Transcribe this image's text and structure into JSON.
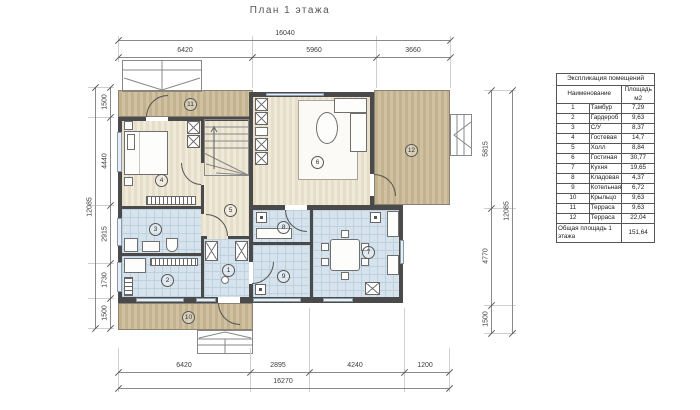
{
  "title": "План 1 этажа",
  "plan": {
    "room_numbers": [
      "1",
      "2",
      "3",
      "4",
      "5",
      "6",
      "7",
      "8",
      "9",
      "10",
      "11",
      "12"
    ]
  },
  "dims": {
    "top": {
      "total": "16040",
      "segments": [
        "6420",
        "5960",
        "3660"
      ]
    },
    "bottom": {
      "total": "16270",
      "segments": [
        "6420",
        "2895",
        "4240",
        "1200"
      ]
    },
    "left": {
      "total": "12085",
      "segments": [
        "1500",
        "4440",
        "2915",
        "1730",
        "1500"
      ]
    },
    "right": {
      "total": "12085",
      "segments": [
        "5815",
        "4770",
        "1500"
      ]
    }
  },
  "table": {
    "title": "Экспликация помещений",
    "columns": {
      "name": "Наименование",
      "area": "Площадь м2"
    },
    "rows": [
      [
        "1",
        "Тамбур",
        "7,29"
      ],
      [
        "2",
        "Гардероб",
        "9,63"
      ],
      [
        "3",
        "С/У",
        "8,37"
      ],
      [
        "4",
        "Гостевая",
        "14,7"
      ],
      [
        "5",
        "Холл",
        "8,84"
      ],
      [
        "6",
        "Гостиная",
        "30,77"
      ],
      [
        "7",
        "Кухня",
        "19,65"
      ],
      [
        "8",
        "Кладовая",
        "4,37"
      ],
      [
        "9",
        "Котельная",
        "6,72"
      ],
      [
        "10",
        "Крыльцо",
        "9,63"
      ],
      [
        "11",
        "Терраса",
        "9,63"
      ],
      [
        "12",
        "Терраса",
        "22,04"
      ]
    ],
    "total_label": "Общая площадь 1 этажа",
    "total_value": "151,64"
  },
  "colors": {
    "wall": "#4a4a4a",
    "wood": "#eae3d2",
    "terrace": "#c9ba96",
    "tile": "#d6e3ed"
  }
}
